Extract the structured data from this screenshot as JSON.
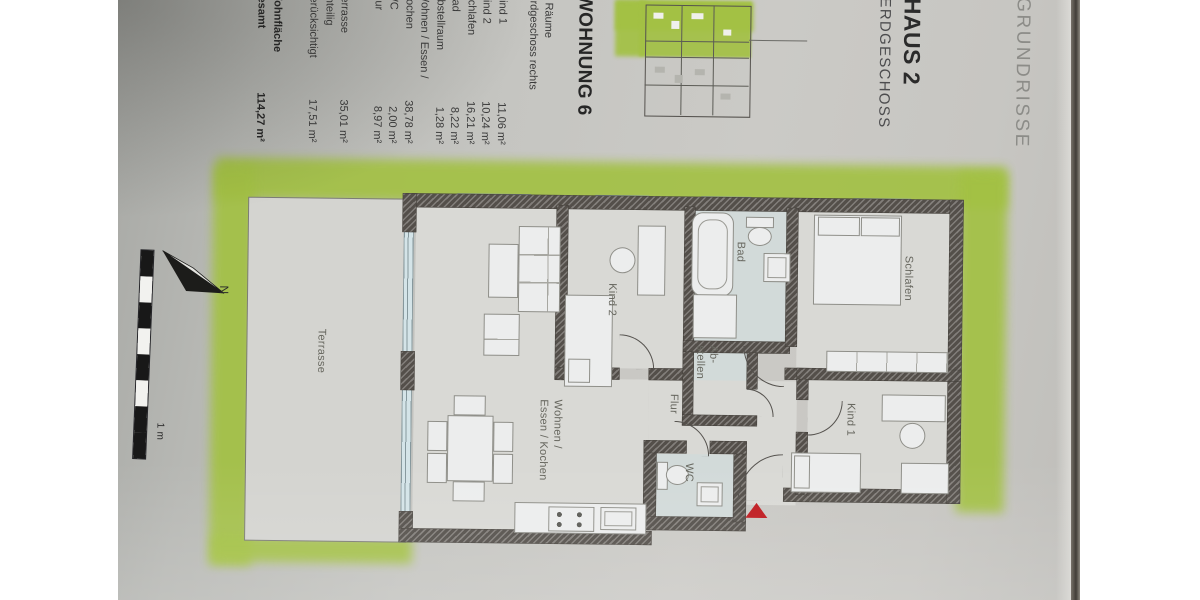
{
  "header": {
    "grundrisse": "GRUNDRISSE",
    "haus": "HAUS 2",
    "geschoss": "ERDGESCHOSS"
  },
  "apartment": {
    "title": "WOHNUNG 6",
    "subtitle_rooms": "4 Räume",
    "subtitle_floor": "Erdgeschoss rechts",
    "rooms": [
      {
        "name": "Kind 1",
        "area": "11,06 m²"
      },
      {
        "name": "Kind 2",
        "area": "10,24 m²"
      },
      {
        "name": "Schlafen",
        "area": "16,21 m²"
      },
      {
        "name": "Bad",
        "area": "8,22 m²"
      },
      {
        "name": "Abstellraum",
        "area": "1,28 m²"
      },
      {
        "name": "Wohnen / Essen /",
        "area": ""
      },
      {
        "name": "Kochen",
        "area": "38,78 m²"
      },
      {
        "name": "WC",
        "area": "2,00 m²"
      },
      {
        "name": "Flur",
        "area": "8,97 m²"
      }
    ],
    "terrace": [
      {
        "name": "Terrasse",
        "area": "35,01 m²"
      },
      {
        "name": "anteilig",
        "area": ""
      },
      {
        "name": "berücksichtigt",
        "area": "17,51 m²"
      }
    ],
    "total": {
      "label_line1": "Wohnfläche",
      "label_line2": "gesamt",
      "value": "114,27 m²"
    }
  },
  "plan": {
    "labels": {
      "terrasse": "Terrasse",
      "kind2": "Kind 2",
      "bad": "Bad",
      "abstell_line1": "Ab-",
      "abstell_line2": "stellen",
      "schlafen": "Schlafen",
      "flur": "Flur",
      "wc": "WC",
      "kind1": "Kind 1",
      "wohnen_line1": "Wohnen /",
      "wohnen_line2": "Essen / Kochen"
    },
    "compass_north": "N",
    "scale_label": "1 m",
    "colors": {
      "garden_green": "#a3c144",
      "entry_marker_red": "#bf1a1f"
    }
  }
}
